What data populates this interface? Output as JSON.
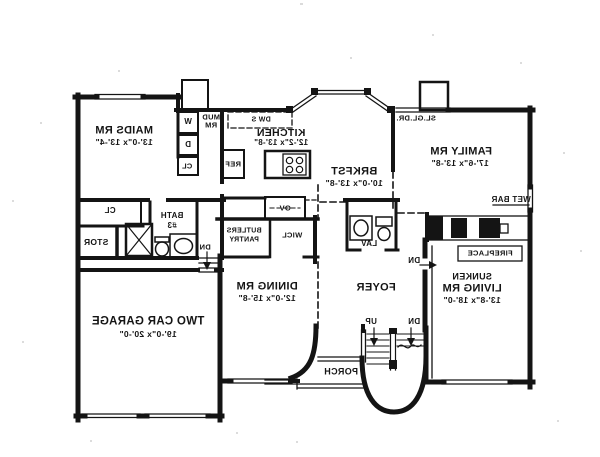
{
  "colors": {
    "ink": "#141414",
    "paper": "#ffffff"
  },
  "rooms": {
    "maids": {
      "name": "MAIDS RM",
      "dims": "13'-0\"x 13'-4\""
    },
    "mud": {
      "line1": "MUD",
      "line2": "RM"
    },
    "kitchen": {
      "name": "KITCHEN",
      "dims": "12'-2\"x 13'-8\""
    },
    "brkfst": {
      "name": "BRKFST",
      "dims": "10'-0\"x 13'-8\""
    },
    "family": {
      "name": "FAMILY RM",
      "dims": "17'-6\"x 13'-8\""
    },
    "living": {
      "prefix": "SUNKEN",
      "name": "LIVING RM",
      "dims": "13'-8\"x 18'-0\""
    },
    "dining": {
      "name": "DINING RM",
      "dims": "12'-0\"x 15'-8\""
    },
    "foyer": {
      "name": "FOYER"
    },
    "garage": {
      "name": "TWO CAR GARAGE",
      "dims": "19'-0\"x 20'-0\""
    },
    "porch": {
      "name": "PORCH"
    },
    "bath": {
      "line1": "BATH",
      "line2": "#3"
    },
    "stor": {
      "name": "STOR"
    },
    "butlers": {
      "line1": "BUTLERS",
      "line2": "PANTRY"
    },
    "wicl": {
      "name": "WICL"
    },
    "lav": {
      "name": "LAV"
    }
  },
  "fixtures": {
    "washer": "W",
    "dryer": "D",
    "mud_closet": "CL",
    "hall_closet": "CL",
    "ref": "REF",
    "dishwasher_sink": "DW S",
    "oven": "OV",
    "wet_bar": "WET BAR",
    "fireplace": "FIREPLACE",
    "sliding_door": "SL.GL.DR."
  },
  "stairs": {
    "up": "UP",
    "down": "DN"
  },
  "annotations": {
    "dn_living": "DN",
    "dn_garage": "DN"
  }
}
